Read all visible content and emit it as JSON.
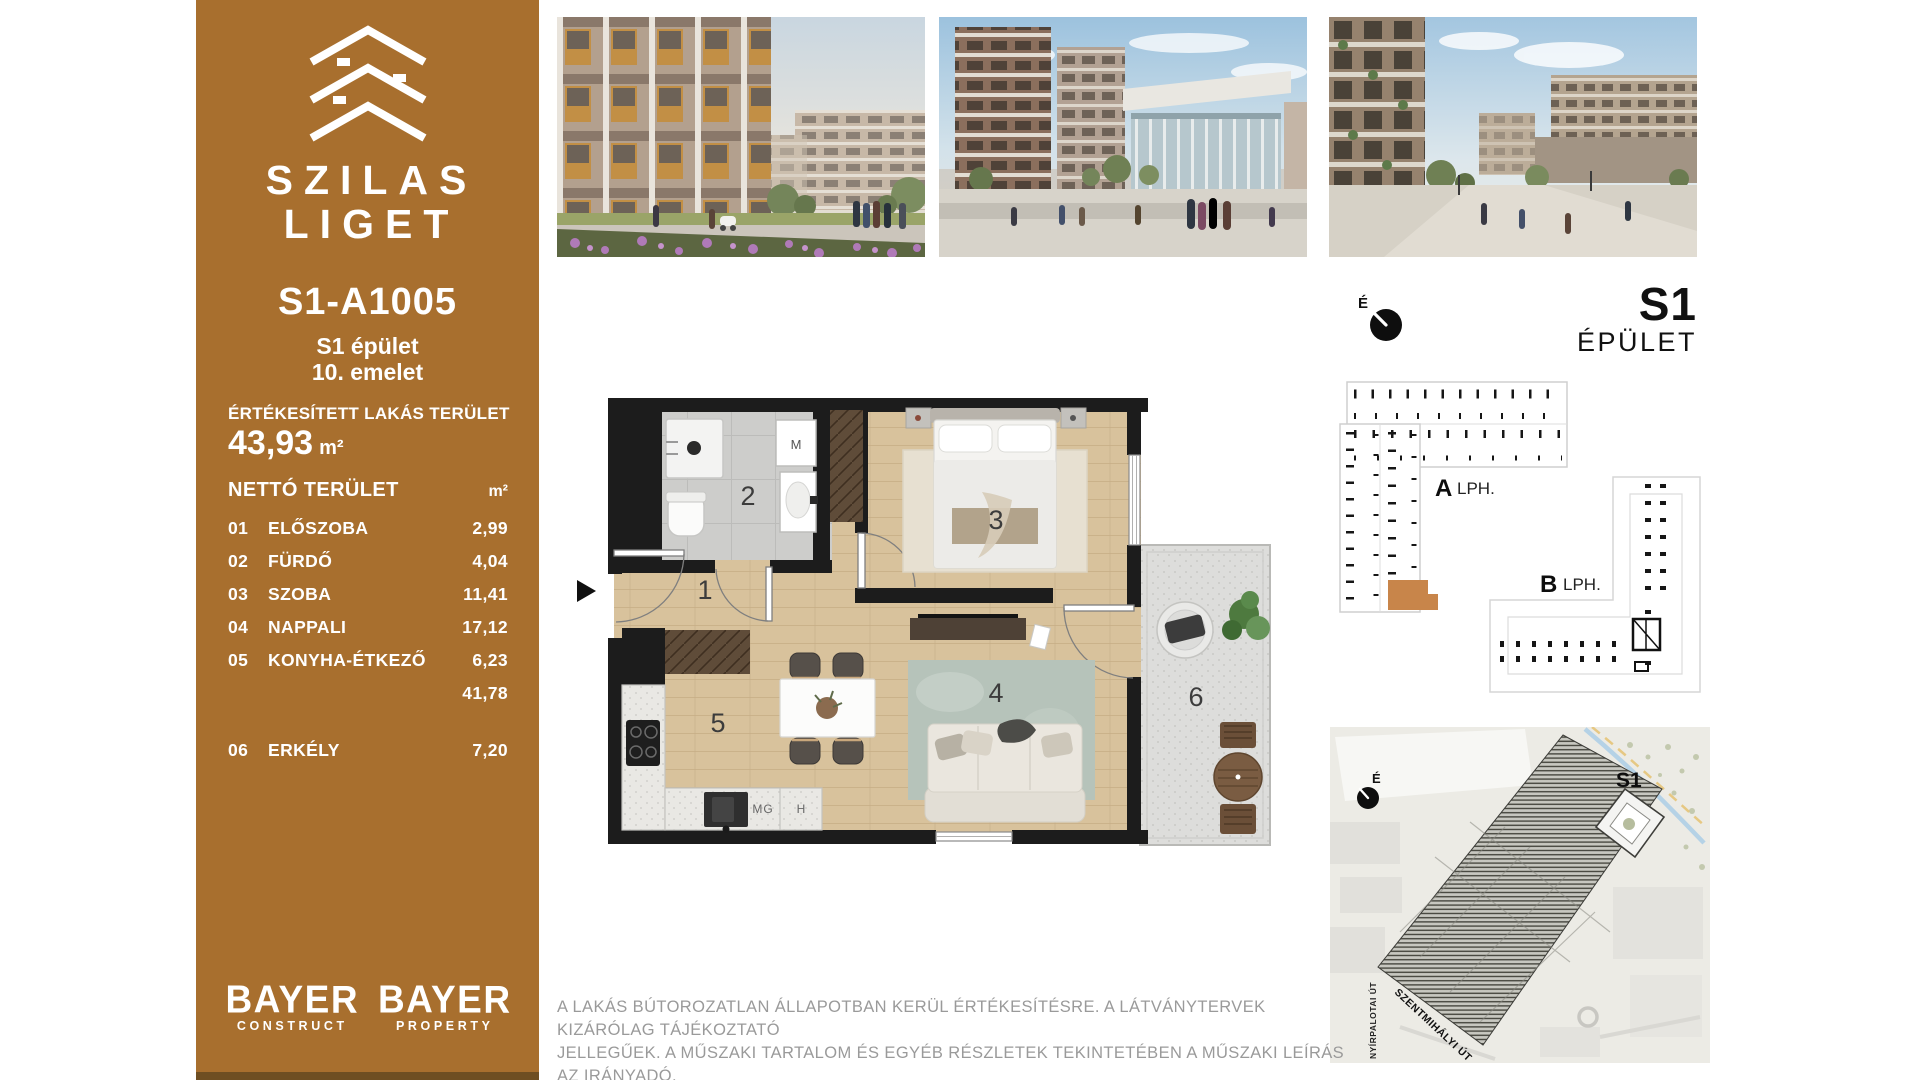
{
  "sidebar": {
    "brand": {
      "line1": "SZILAS",
      "line2": "LIGET"
    },
    "unit_id": "S1-A1005",
    "building": "S1 épület",
    "floor": "10. emelet",
    "sold_area_label": "ÉRTÉKESÍTETT LAKÁS TERÜLET",
    "sold_area_value": "43,93",
    "sold_area_unit": "m²",
    "net_area_label": "NETTÓ TERÜLET",
    "net_area_unit": "m²",
    "rooms": [
      {
        "num": "01",
        "name": "ELŐSZOBA",
        "area": "2,99"
      },
      {
        "num": "02",
        "name": "FÜRDŐ",
        "area": "4,04"
      },
      {
        "num": "03",
        "name": "SZOBA",
        "area": "11,41"
      },
      {
        "num": "04",
        "name": "NAPPALI",
        "area": "17,12"
      },
      {
        "num": "05",
        "name": "KONYHA-ÉTKEZŐ",
        "area": "6,23"
      }
    ],
    "subtotal": "41,78",
    "balcony_row": {
      "num": "06",
      "name": "ERKÉLY",
      "area": "7,20"
    },
    "logos": [
      {
        "name": "BAYER",
        "sub": "CONSTRUCT"
      },
      {
        "name": "BAYER",
        "sub": "PROPERTY"
      }
    ],
    "accent_color": "#a86f2e"
  },
  "floorplan": {
    "labels": [
      "1",
      "2",
      "3",
      "4",
      "5",
      "6"
    ],
    "appliances": {
      "m": "M",
      "mg": "MG",
      "h": "H"
    }
  },
  "keyplan": {
    "compass": "É",
    "building_code": "S1",
    "building_label": "ÉPÜLET",
    "stair_a": {
      "letter": "A",
      "text": "LPH."
    },
    "stair_b": {
      "letter": "B",
      "text": "LPH."
    },
    "highlight_color": "#c8854a"
  },
  "sitemap": {
    "compass": "É",
    "building_label": "S1",
    "street_diagonal": "SZENTMIHÁLYI ÚT",
    "street_vertical": "NYÍRPALOTAI ÚT"
  },
  "disclaimer": {
    "line1": "A LAKÁS BÚTOROZATLAN ÁLLAPOTBAN KERÜL ÉRTÉKESÍTÉSRE. A LÁTVÁNYTERVEK KIZÁRÓLAG TÁJÉKOZTATÓ",
    "line2": "JELLEGŰEK. A MŰSZAKI TARTALOM ÉS EGYÉB RÉSZLETEK TEKINTETÉBEN A MŰSZAKI LEÍRÁS AZ IRÁNYADÓ."
  }
}
